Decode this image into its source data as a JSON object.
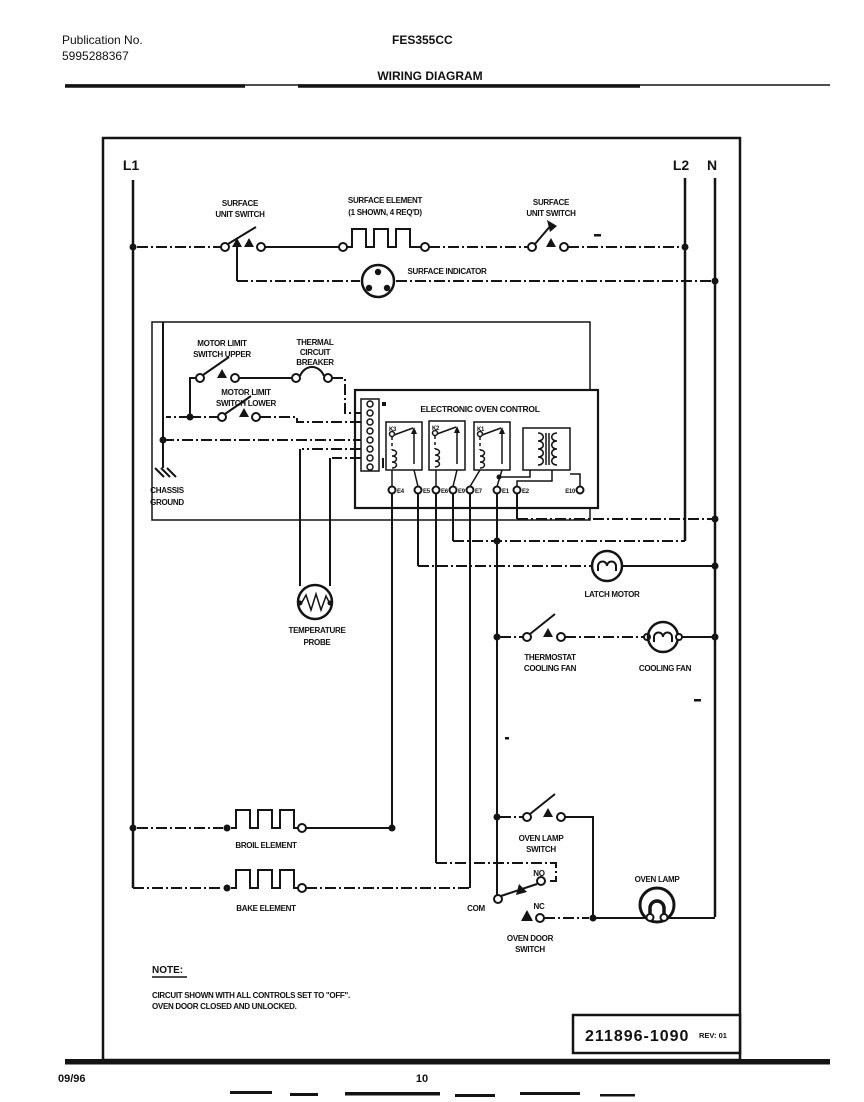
{
  "header": {
    "publication_label": "Publication No.",
    "publication_number": "5995288367",
    "model": "FES355CC",
    "page_title": "WIRING DIAGRAM"
  },
  "buses": {
    "l1": "L1",
    "l2": "L2",
    "n": "N"
  },
  "labels": {
    "surface_unit_switch_left": [
      "SURFACE",
      "UNIT SWITCH"
    ],
    "surface_element": [
      "SURFACE ELEMENT",
      "(1 SHOWN, 4 REQ'D)"
    ],
    "surface_unit_switch_right": [
      "SURFACE",
      "UNIT SWITCH"
    ],
    "surface_indicator": "SURFACE INDICATOR",
    "motor_limit_switch_upper": [
      "MOTOR LIMIT",
      "SWITCH UPPER"
    ],
    "thermal_circuit_breaker": [
      "THERMAL",
      "CIRCUIT",
      "BREAKER"
    ],
    "motor_limit_switch_lower": [
      "MOTOR LIMIT",
      "SWITCH LOWER"
    ],
    "chassis_ground": [
      "CHASSIS",
      "GROUND"
    ],
    "temperature_probe": [
      "TEMPERATURE",
      "PROBE"
    ],
    "latch_motor": "LATCH MOTOR",
    "thermostat_cooling_fan": [
      "THERMOSTAT",
      "COOLING FAN"
    ],
    "cooling_fan": "COOLING FAN",
    "broil_element": "BROIL ELEMENT",
    "bake_element": "BAKE ELEMENT",
    "oven_lamp_switch": [
      "OVEN LAMP",
      "SWITCH"
    ],
    "oven_lamp": "OVEN LAMP",
    "oven_door_switch": [
      "OVEN DOOR",
      "SWITCH"
    ],
    "door_no": "NO",
    "door_com": "COM",
    "door_nc": "NC"
  },
  "eoc": {
    "title": "ELECTRONIC OVEN CONTROL",
    "relays": [
      "K3",
      "K2",
      "K1"
    ],
    "terminals": [
      "E4",
      "E5",
      "E6",
      "E9",
      "E7",
      "E1",
      "E2",
      "E10"
    ]
  },
  "note": {
    "heading": "NOTE:",
    "lines": [
      "CIRCUIT SHOWN WITH ALL CONTROLS SET TO \"OFF\".",
      "OVEN DOOR CLOSED AND UNLOCKED."
    ]
  },
  "part_box": {
    "number": "211896-1090",
    "revision": "REV: 01"
  },
  "footer": {
    "date": "09/96",
    "page_number": "10"
  }
}
